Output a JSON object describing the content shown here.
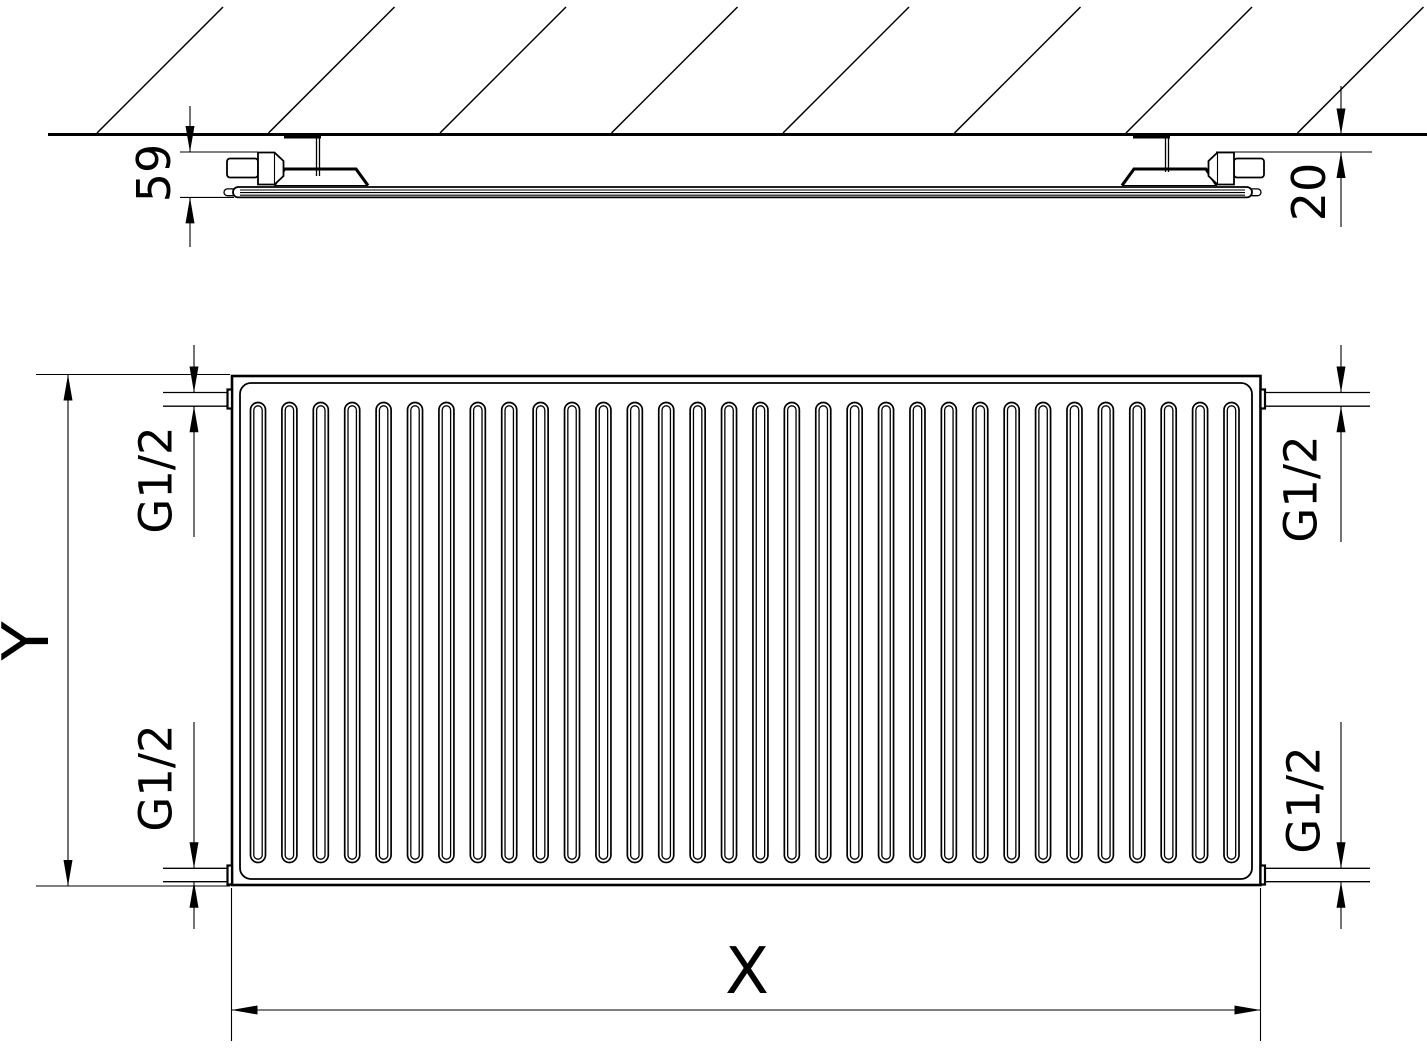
{
  "drawing": {
    "title": "panel-radiator-technical-drawing",
    "colors": {
      "line": "#000000",
      "background": "#ffffff"
    },
    "section_view": {
      "depth_dim": "59",
      "wall_distance_dim": "20"
    },
    "front_view": {
      "width_dim": "X",
      "height_dim": "Y",
      "connections": {
        "top_left": "G1/2",
        "bottom_left": "G1/2",
        "top_right": "G1/2",
        "bottom_right": "G1/2"
      },
      "channel_count": 32
    },
    "hatch_line_count": 8
  }
}
